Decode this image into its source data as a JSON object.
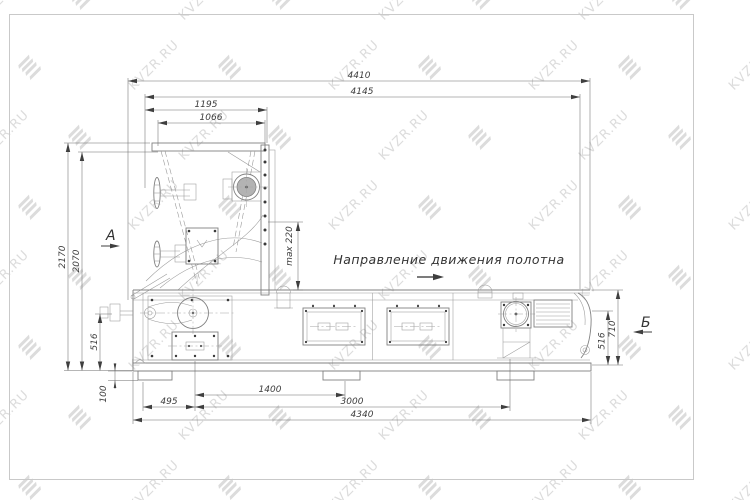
{
  "drawing": {
    "direction_label": "Направление движения полотна",
    "view_labels": {
      "a": "А",
      "b": "Б"
    },
    "dimensions": {
      "top": {
        "d4410": "4410",
        "d4145": "4145",
        "d1195": "1195",
        "d1066": "1066"
      },
      "left": {
        "d2170": "2170",
        "d2070": "2070",
        "d516": "516",
        "d100": "100"
      },
      "center": {
        "dmax220": "max 220"
      },
      "right": {
        "d516": "516",
        "d710": "710"
      },
      "bottom": {
        "d495": "495",
        "d1400": "1400",
        "d3000": "3000",
        "d4340": "4340"
      }
    }
  },
  "watermark": {
    "text": "KVZR.RU"
  }
}
